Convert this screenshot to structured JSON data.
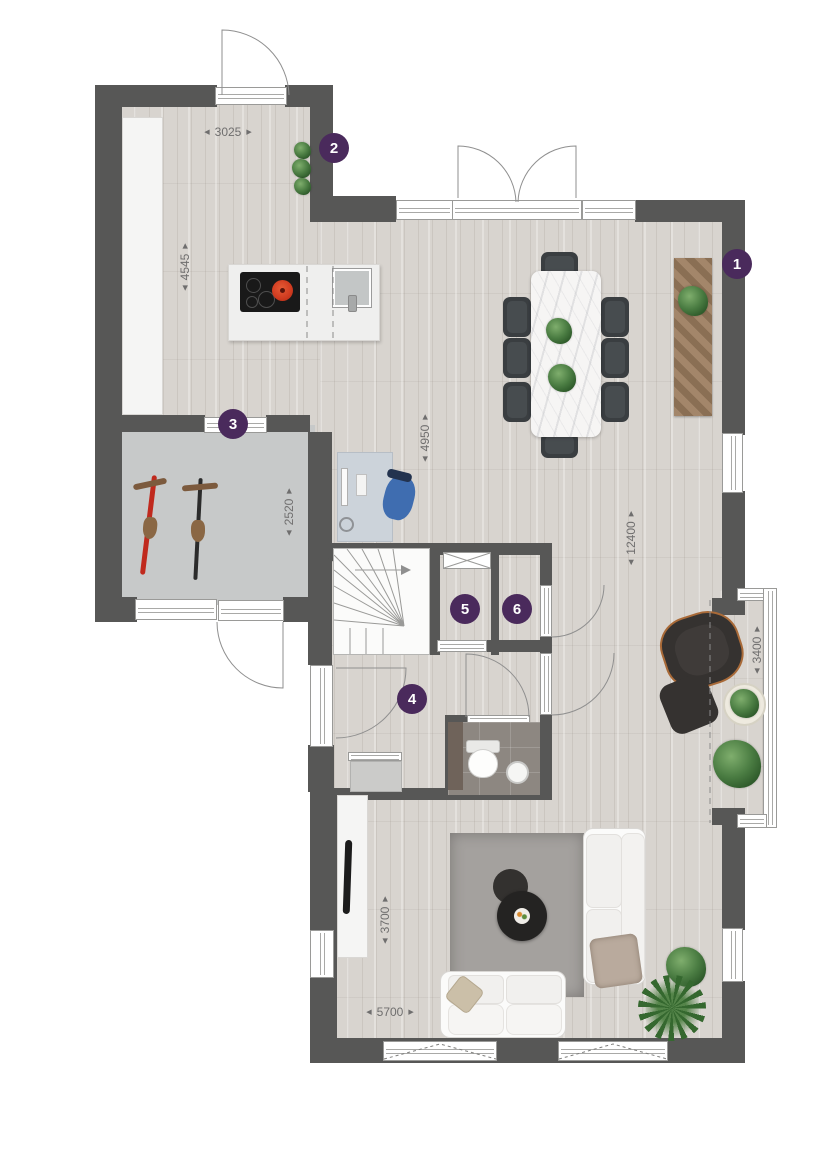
{
  "plan_type": "ground-floor-plan",
  "colors": {
    "wall": "#575756",
    "marker_bg": "#4a2a5c",
    "marker_text": "#ffffff",
    "dim_text": "#6f6e6e",
    "floor_wood": "#d8d4cf",
    "floor_storage": "#c7c9c9",
    "floor_wc": "#8d8781",
    "pot_red": "#cf3a1f",
    "desk_chair_blue": "#3f6db0",
    "sideboard_wood": "#9b7e60"
  },
  "ui": {
    "arrow_left": "◀",
    "arrow_right": "▶"
  },
  "markers": [
    {
      "label": "1"
    },
    {
      "label": "2"
    },
    {
      "label": "3"
    },
    {
      "label": "4"
    },
    {
      "label": "5"
    },
    {
      "label": "6"
    }
  ],
  "dimensions": {
    "kitchen_width": {
      "value": "3025"
    },
    "kitchen_depth": {
      "value": "4545"
    },
    "storage_depth": {
      "value": "2520"
    },
    "hall_span": {
      "value": "4950"
    },
    "house_depth": {
      "value": "12400"
    },
    "bay_span": {
      "value": "3400"
    },
    "living_depth": {
      "value": "3700"
    },
    "living_width": {
      "value": "5700"
    }
  }
}
